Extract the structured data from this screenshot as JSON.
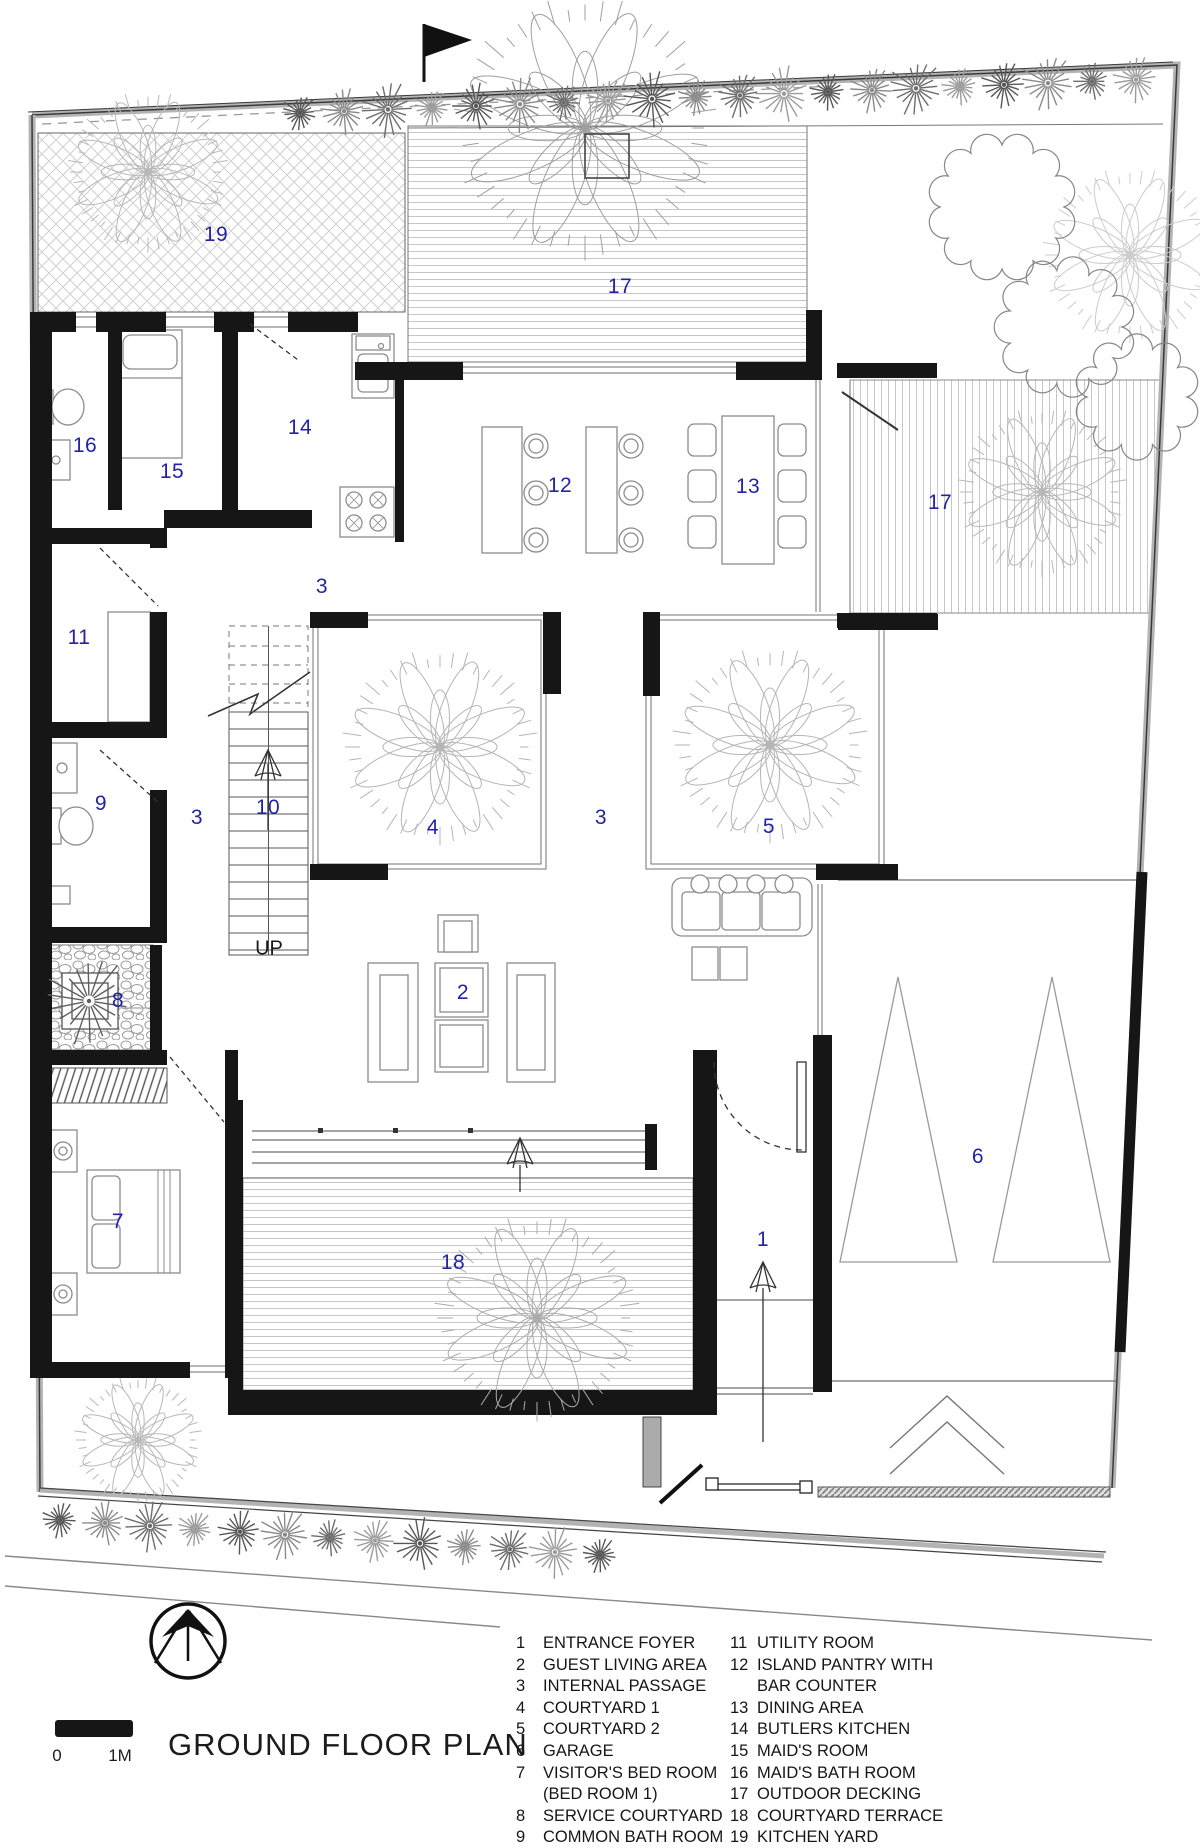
{
  "title": "GROUND FLOOR PLAN",
  "scale_bar": {
    "zero": "0",
    "one_m": "1M"
  },
  "stair": {
    "up_label": "UP"
  },
  "plan": {
    "label_color": "#2323a8",
    "labels": [
      {
        "n": "19",
        "x": 216,
        "y": 235
      },
      {
        "n": "17",
        "x": 620,
        "y": 287
      },
      {
        "n": "16",
        "x": 85,
        "y": 446
      },
      {
        "n": "15",
        "x": 172,
        "y": 472
      },
      {
        "n": "14",
        "x": 300,
        "y": 428
      },
      {
        "n": "12",
        "x": 560,
        "y": 486
      },
      {
        "n": "13",
        "x": 748,
        "y": 487
      },
      {
        "n": "17",
        "x": 940,
        "y": 503
      },
      {
        "n": "3",
        "x": 322,
        "y": 587
      },
      {
        "n": "11",
        "x": 79,
        "y": 638
      },
      {
        "n": "10",
        "x": 268,
        "y": 808
      },
      {
        "n": "3",
        "x": 197,
        "y": 818
      },
      {
        "n": "4",
        "x": 433,
        "y": 828
      },
      {
        "n": "3",
        "x": 601,
        "y": 818
      },
      {
        "n": "5",
        "x": 769,
        "y": 827
      },
      {
        "n": "9",
        "x": 101,
        "y": 804
      },
      {
        "n": "8",
        "x": 118,
        "y": 1001
      },
      {
        "n": "2",
        "x": 463,
        "y": 993
      },
      {
        "n": "7",
        "x": 118,
        "y": 1222
      },
      {
        "n": "18",
        "x": 453,
        "y": 1263
      },
      {
        "n": "1",
        "x": 763,
        "y": 1240
      },
      {
        "n": "6",
        "x": 978,
        "y": 1157
      }
    ]
  },
  "legend": {
    "col1": [
      {
        "n": "1",
        "label": "ENTRANCE FOYER"
      },
      {
        "n": "2",
        "label": "GUEST LIVING AREA"
      },
      {
        "n": "3",
        "label": "INTERNAL PASSAGE"
      },
      {
        "n": "4",
        "label": "COURTYARD 1"
      },
      {
        "n": "5",
        "label": "COURTYARD 2"
      },
      {
        "n": "6",
        "label": "GARAGE"
      },
      {
        "n": "7",
        "label": "VISITOR'S BED ROOM\n(BED ROOM 1)"
      },
      {
        "n": "8",
        "label": "SERVICE COURTYARD"
      },
      {
        "n": "9",
        "label": "COMMON BATH ROOM"
      },
      {
        "n": "10",
        "label": "STAIRCASE"
      }
    ],
    "col2": [
      {
        "n": "11",
        "label": "UTILITY ROOM"
      },
      {
        "n": "12",
        "label": "ISLAND PANTRY WITH\nBAR COUNTER"
      },
      {
        "n": "13",
        "label": "DINING AREA"
      },
      {
        "n": "14",
        "label": "BUTLERS KITCHEN"
      },
      {
        "n": "15",
        "label": "MAID'S ROOM"
      },
      {
        "n": "16",
        "label": "MAID'S BATH ROOM"
      },
      {
        "n": "17",
        "label": "OUTDOOR DECKING"
      },
      {
        "n": "18",
        "label": "COURTYARD TERRACE"
      },
      {
        "n": "19",
        "label": "KITCHEN YARD"
      }
    ]
  }
}
